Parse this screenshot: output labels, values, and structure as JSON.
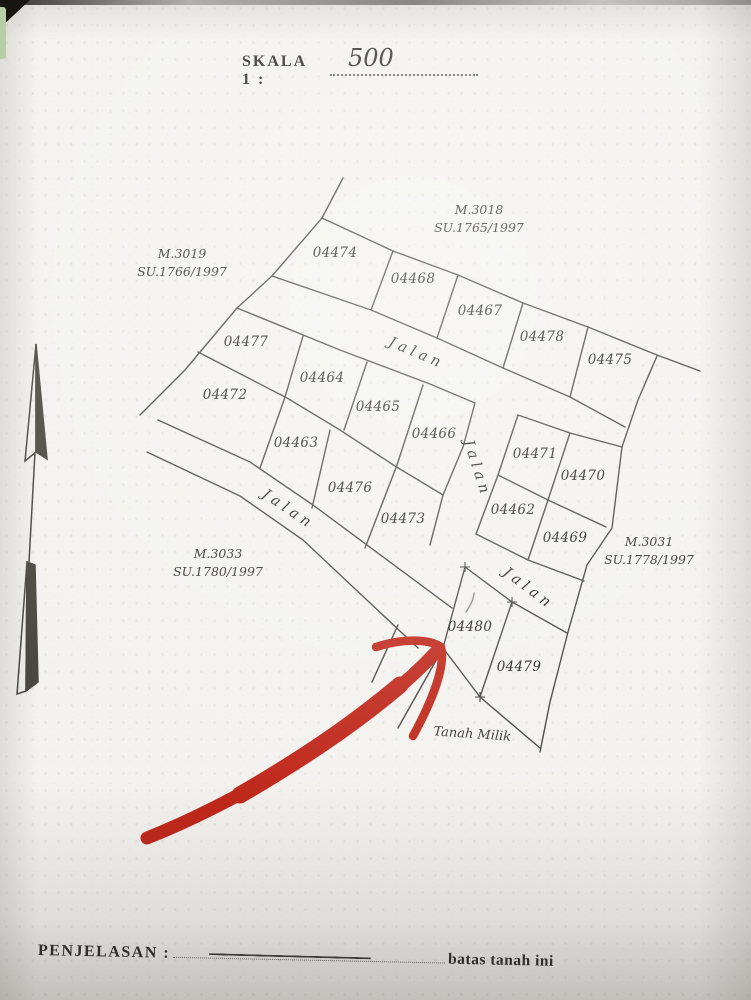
{
  "header": {
    "scale_label": "SKALA 1 :",
    "scale_value": "500"
  },
  "map": {
    "road_label": "Jalan",
    "parcels": [
      {
        "number": "04474",
        "x": 335,
        "y": 257
      },
      {
        "number": "04468",
        "x": 413,
        "y": 283
      },
      {
        "number": "04467",
        "x": 480,
        "y": 315
      },
      {
        "number": "04478",
        "x": 542,
        "y": 341
      },
      {
        "number": "04475",
        "x": 610,
        "y": 364
      },
      {
        "number": "04477",
        "x": 246,
        "y": 346
      },
      {
        "number": "04464",
        "x": 322,
        "y": 382
      },
      {
        "number": "04465",
        "x": 378,
        "y": 411
      },
      {
        "number": "04466",
        "x": 434,
        "y": 438
      },
      {
        "number": "04472",
        "x": 225,
        "y": 399
      },
      {
        "number": "04463",
        "x": 296,
        "y": 447
      },
      {
        "number": "04476",
        "x": 350,
        "y": 492
      },
      {
        "number": "04473",
        "x": 403,
        "y": 523
      },
      {
        "number": "04471",
        "x": 535,
        "y": 458
      },
      {
        "number": "04470",
        "x": 583,
        "y": 480
      },
      {
        "number": "04462",
        "x": 513,
        "y": 514
      },
      {
        "number": "04469",
        "x": 565,
        "y": 542
      },
      {
        "number": "04480",
        "x": 470,
        "y": 631
      },
      {
        "number": "04479",
        "x": 519,
        "y": 671
      }
    ],
    "roads": [
      {
        "x": 415,
        "y": 357,
        "angle": 23
      },
      {
        "x": 286,
        "y": 513,
        "angle": 34
      },
      {
        "x": 473,
        "y": 470,
        "angle": 72
      },
      {
        "x": 526,
        "y": 592,
        "angle": 37
      }
    ],
    "neighbors": [
      {
        "title": "M.3018",
        "subtitle": "SU.1765/1997",
        "x": 479,
        "y": 214
      },
      {
        "title": "M.3019",
        "subtitle": "SU.1766/1997",
        "x": 182,
        "y": 258
      },
      {
        "title": "M.3033",
        "subtitle": "SU.1780/1997",
        "x": 218,
        "y": 558
      },
      {
        "title": "M.3031",
        "subtitle": "SU.1778/1997",
        "x": 649,
        "y": 546
      }
    ],
    "markers": [
      {
        "x": 465,
        "y": 567
      },
      {
        "x": 512,
        "y": 602
      },
      {
        "x": 480,
        "y": 697
      }
    ],
    "land_note": {
      "text": "Tanah Milik",
      "x": 472,
      "y": 738,
      "angle": 4
    }
  },
  "footer": {
    "label": "PENJELASAN :",
    "value": "batas tanah ini"
  },
  "colors": {
    "ink": "#46443f",
    "annotation_red": "#bf2619",
    "paper": "#f3f2ef"
  },
  "icons": {
    "north_arrow": "north-arrow",
    "corner_marker": "survey-cross"
  }
}
